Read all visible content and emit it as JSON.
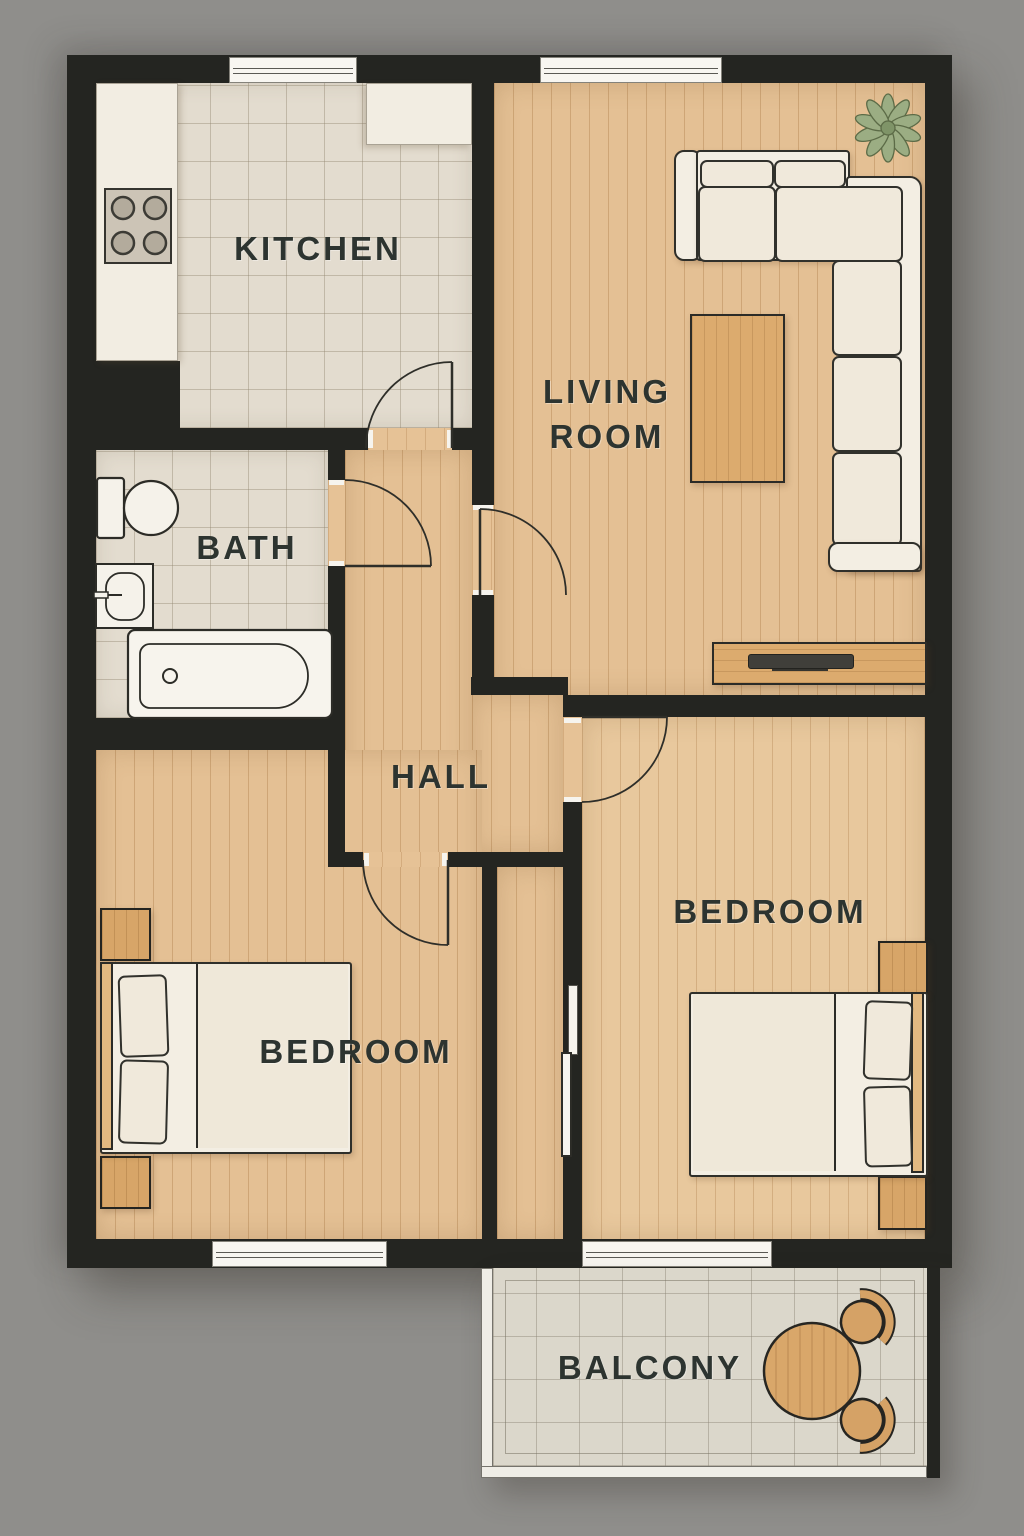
{
  "plan": {
    "rooms": {
      "kitchen": {
        "label": "KITCHEN"
      },
      "living_room": {
        "label": "LIVING ROOM",
        "line1": "LIVING",
        "line2": "ROOM"
      },
      "bath": {
        "label": "BATH"
      },
      "hall": {
        "label": "HALL"
      },
      "bedroom_left": {
        "label": "BEDROOM"
      },
      "bedroom_right": {
        "label": "BEDROOM"
      },
      "balcony": {
        "label": "BALCONY"
      }
    },
    "colors": {
      "background": "#8f8e8b",
      "wall": "#242521",
      "wood_floor": "#e4c094",
      "tile_floor": "#e3dccf",
      "balcony_tile": "#dbd7cb",
      "furniture_white": "#f3eee3",
      "furniture_wood": "#d7a568",
      "plant_green": "#9bad83",
      "label_text": "#2d3430"
    }
  }
}
